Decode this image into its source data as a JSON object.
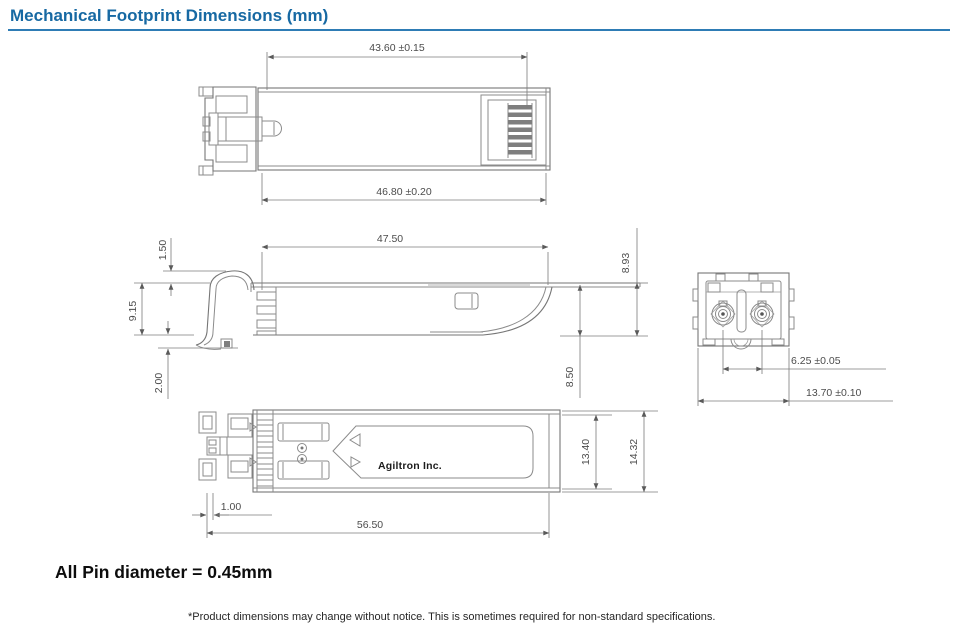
{
  "page": {
    "title": "Mechanical Footprint Dimensions (mm)"
  },
  "drawing": {
    "brand_label": "Agiltron Inc.",
    "dimensions": {
      "top_front_width": "43.60 ±0.15",
      "top_overall_width": "46.80 ±0.20",
      "side_shell_length": "47.50",
      "side_bail_offset": "1.50",
      "side_front_height": "9.15",
      "side_foot_offset": "2.00",
      "side_rear_height_outer": "8.93",
      "side_rear_height_inner": "8.50",
      "end_ferrule_pitch": "6.25 ±0.05",
      "end_overall_width": "13.70 ±0.10",
      "bottom_body_width": "13.40",
      "bottom_overall_width": "14.32",
      "bottom_front_offset": "1.00",
      "bottom_overall_length": "56.50"
    }
  },
  "notes": {
    "pin_diameter": "All Pin diameter = 0.45mm",
    "disclaimer": "*Product dimensions may change without notice. This is sometimes required for non-standard specifications."
  }
}
